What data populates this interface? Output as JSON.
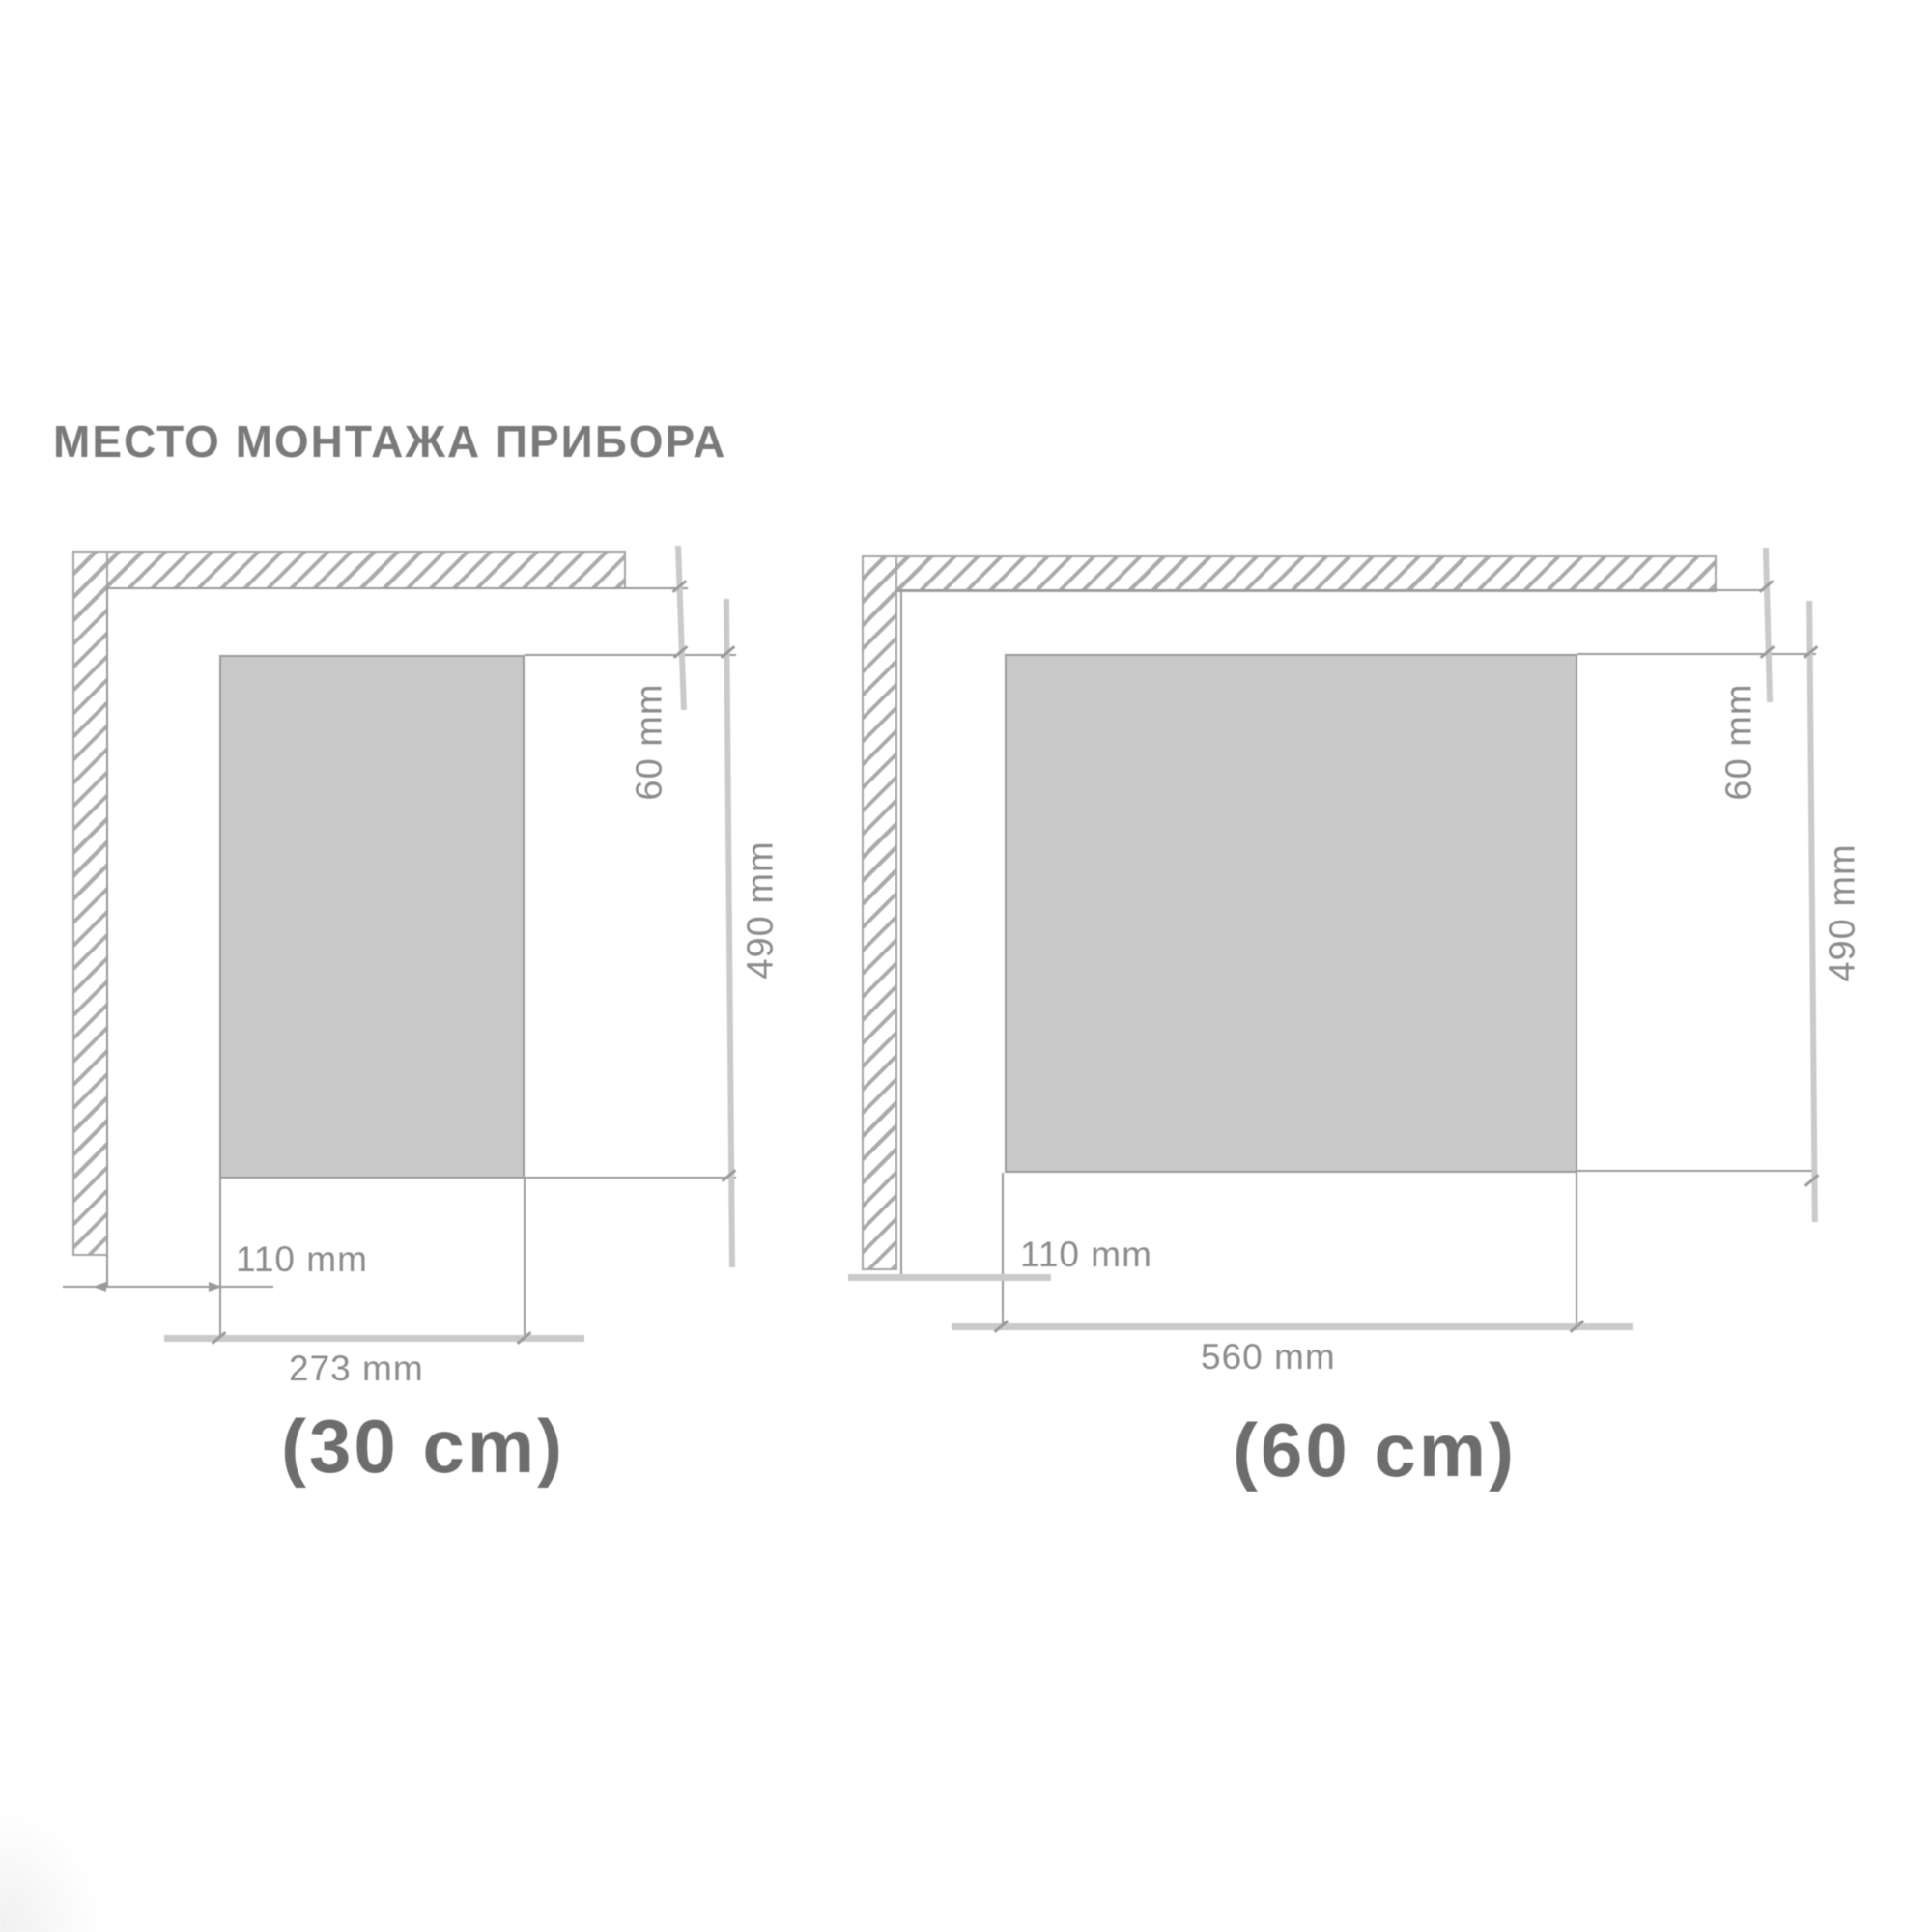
{
  "title": "МЕСТО МОНТАЖА ПРИБОРА",
  "colors": {
    "title": "#7a7a7a",
    "line": "#9a9a9a",
    "thick_dim": "#cacaca",
    "hatch_border": "#a5a5a5",
    "hatch_stroke": "#ababab",
    "cutout_fill": "#c9c9c9",
    "cutout_border": "#9b9b9b",
    "label": "#8c8c8c",
    "caption": "#6d6d6d"
  },
  "diagrams": [
    {
      "id": "30cm",
      "caption": "(30 cm)",
      "back_gap_label": "60 mm",
      "depth_label": "490 mm",
      "side_gap_label": "110 mm",
      "width_label": "273 mm"
    },
    {
      "id": "60cm",
      "caption": "(60 cm)",
      "back_gap_label": "60 mm",
      "depth_label": "490 mm",
      "side_gap_label": "110 mm",
      "width_label": "560 mm"
    }
  ]
}
